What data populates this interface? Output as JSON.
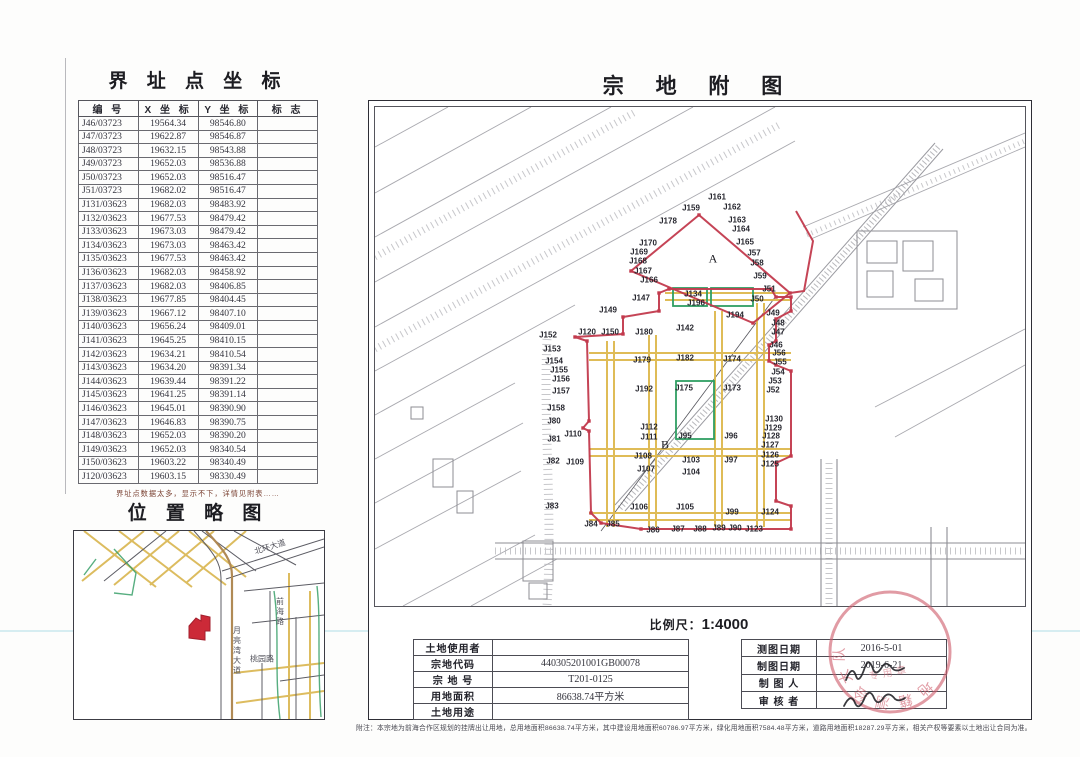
{
  "colors": {
    "boundary_red": "#c23a4d",
    "road_yellow": "#deb94f",
    "parcel_green": "#2f9e63",
    "topo_gray": "#a0a0a6",
    "seal_red": "#cf5f6e"
  },
  "coord": {
    "title": "界 址 点 坐 标",
    "headers": [
      "编    号",
      "X 坐 标",
      "Y 坐 标",
      "标    志"
    ],
    "rows": [
      [
        "J46/03723",
        "19564.34",
        "98546.80",
        ""
      ],
      [
        "J47/03723",
        "19622.87",
        "98546.87",
        ""
      ],
      [
        "J48/03723",
        "19632.15",
        "98543.88",
        ""
      ],
      [
        "J49/03723",
        "19652.03",
        "98536.88",
        ""
      ],
      [
        "J50/03723",
        "19652.03",
        "98516.47",
        ""
      ],
      [
        "J51/03723",
        "19682.02",
        "98516.47",
        ""
      ],
      [
        "J131/03623",
        "19682.03",
        "98483.92",
        ""
      ],
      [
        "J132/03623",
        "19677.53",
        "98479.42",
        ""
      ],
      [
        "J133/03623",
        "19673.03",
        "98479.42",
        ""
      ],
      [
        "J134/03623",
        "19673.03",
        "98463.42",
        ""
      ],
      [
        "J135/03623",
        "19677.53",
        "98463.42",
        ""
      ],
      [
        "J136/03623",
        "19682.03",
        "98458.92",
        ""
      ],
      [
        "J137/03623",
        "19682.03",
        "98406.85",
        ""
      ],
      [
        "J138/03623",
        "19677.85",
        "98404.45",
        ""
      ],
      [
        "J139/03623",
        "19667.12",
        "98407.10",
        ""
      ],
      [
        "J140/03623",
        "19656.24",
        "98409.01",
        ""
      ],
      [
        "J141/03623",
        "19645.25",
        "98410.15",
        ""
      ],
      [
        "J142/03623",
        "19634.21",
        "98410.54",
        ""
      ],
      [
        "J143/03623",
        "19634.20",
        "98391.34",
        ""
      ],
      [
        "J144/03623",
        "19639.44",
        "98391.22",
        ""
      ],
      [
        "J145/03623",
        "19641.25",
        "98391.14",
        ""
      ],
      [
        "J146/03623",
        "19645.01",
        "98390.90",
        ""
      ],
      [
        "J147/03623",
        "19646.83",
        "98390.75",
        ""
      ],
      [
        "J148/03623",
        "19652.03",
        "98390.20",
        ""
      ],
      [
        "J149/03623",
        "19652.03",
        "98340.54",
        ""
      ],
      [
        "J150/03623",
        "19603.22",
        "98340.49",
        ""
      ],
      [
        "J120/03623",
        "19603.15",
        "98330.49",
        ""
      ]
    ],
    "footnote": "界址点数据太多，显示不下，详情见附表……"
  },
  "location_map": {
    "title": "位 置 略 图",
    "labels": [
      {
        "t": "北环大道",
        "x": 196,
        "y": 16,
        "r": -17
      },
      {
        "t": "月亮湾大道",
        "x": 163,
        "y": 95,
        "v": true
      },
      {
        "t": "前海路",
        "x": 206,
        "y": 66,
        "v": true
      },
      {
        "t": "桃园路",
        "x": 188,
        "y": 128
      }
    ]
  },
  "parcel_map": {
    "title": "宗 地 附 图",
    "scale_label": "比例尺：",
    "scale_value": "1:4000",
    "boundaries": [
      {
        "close": true,
        "dots": true,
        "points": [
          [
            200,
            230
          ],
          [
            248,
            227
          ],
          [
            248,
            210
          ],
          [
            284,
            204
          ],
          [
            284,
            186
          ],
          [
            294,
            182
          ],
          [
            396,
            182
          ],
          [
            401,
            190
          ],
          [
            416,
            190
          ],
          [
            416,
            204
          ],
          [
            401,
            212
          ],
          [
            401,
            234
          ],
          [
            394,
            238
          ],
          [
            394,
            254
          ],
          [
            401,
            258
          ],
          [
            416,
            264
          ],
          [
            416,
            349
          ],
          [
            401,
            356
          ],
          [
            401,
            394
          ],
          [
            416,
            399
          ],
          [
            416,
            422
          ],
          [
            266,
            422
          ],
          [
            226,
            416
          ],
          [
            216,
            406
          ],
          [
            214,
            324
          ],
          [
            208,
            321
          ],
          [
            214,
            314
          ],
          [
            212,
            234
          ]
        ]
      },
      {
        "close": true,
        "dots": true,
        "points": [
          [
            324,
            108
          ],
          [
            415,
            186
          ],
          [
            378,
            216
          ],
          [
            256,
            164
          ]
        ]
      },
      {
        "close": false,
        "dots": false,
        "points": [
          [
            421,
            104
          ],
          [
            438,
            134
          ],
          [
            429,
            184
          ],
          [
            415,
            186
          ]
        ]
      }
    ],
    "labels": [
      {
        "t": "J159",
        "x": 316,
        "y": 101
      },
      {
        "t": "J161",
        "x": 342,
        "y": 90
      },
      {
        "t": "J162",
        "x": 357,
        "y": 100
      },
      {
        "t": "J163",
        "x": 362,
        "y": 113
      },
      {
        "t": "J164",
        "x": 366,
        "y": 122
      },
      {
        "t": "J165",
        "x": 370,
        "y": 135
      },
      {
        "t": "J57",
        "x": 379,
        "y": 146
      },
      {
        "t": "J58",
        "x": 382,
        "y": 156
      },
      {
        "t": "J59",
        "x": 385,
        "y": 169
      },
      {
        "t": "J51",
        "x": 394,
        "y": 182
      },
      {
        "t": "J50",
        "x": 382,
        "y": 192
      },
      {
        "t": "J178",
        "x": 293,
        "y": 114
      },
      {
        "t": "J170",
        "x": 273,
        "y": 136
      },
      {
        "t": "J169",
        "x": 264,
        "y": 145
      },
      {
        "t": "J168",
        "x": 263,
        "y": 154
      },
      {
        "t": "J167",
        "x": 268,
        "y": 164
      },
      {
        "t": "J166",
        "x": 274,
        "y": 173
      },
      {
        "t": "J147",
        "x": 266,
        "y": 191
      },
      {
        "t": "J149",
        "x": 233,
        "y": 203
      },
      {
        "t": "J134",
        "x": 318,
        "y": 187
      },
      {
        "t": "J196",
        "x": 321,
        "y": 196
      },
      {
        "t": "J194",
        "x": 360,
        "y": 208
      },
      {
        "t": "A",
        "x": 338,
        "y": 152,
        "c": "region"
      },
      {
        "t": "J152",
        "x": 173,
        "y": 228
      },
      {
        "t": "J120",
        "x": 212,
        "y": 225
      },
      {
        "t": "J150",
        "x": 235,
        "y": 225
      },
      {
        "t": "J180",
        "x": 269,
        "y": 225
      },
      {
        "t": "J142",
        "x": 310,
        "y": 221
      },
      {
        "t": "J153",
        "x": 177,
        "y": 242
      },
      {
        "t": "J154",
        "x": 179,
        "y": 254
      },
      {
        "t": "J155",
        "x": 184,
        "y": 263
      },
      {
        "t": "J156",
        "x": 186,
        "y": 272
      },
      {
        "t": "J157",
        "x": 186,
        "y": 284
      },
      {
        "t": "J158",
        "x": 181,
        "y": 301
      },
      {
        "t": "J179",
        "x": 267,
        "y": 253
      },
      {
        "t": "J182",
        "x": 310,
        "y": 251
      },
      {
        "t": "J174",
        "x": 357,
        "y": 252
      },
      {
        "t": "J192",
        "x": 269,
        "y": 282
      },
      {
        "t": "J175",
        "x": 309,
        "y": 281
      },
      {
        "t": "J173",
        "x": 357,
        "y": 281
      },
      {
        "t": "J80",
        "x": 179,
        "y": 314
      },
      {
        "t": "J110",
        "x": 198,
        "y": 327
      },
      {
        "t": "J112",
        "x": 274,
        "y": 320
      },
      {
        "t": "J111",
        "x": 274,
        "y": 330
      },
      {
        "t": "J95",
        "x": 310,
        "y": 329
      },
      {
        "t": "J96",
        "x": 356,
        "y": 329
      },
      {
        "t": "J81",
        "x": 179,
        "y": 332
      },
      {
        "t": "B",
        "x": 290,
        "y": 338,
        "c": "region"
      },
      {
        "t": "J82",
        "x": 178,
        "y": 354
      },
      {
        "t": "J109",
        "x": 200,
        "y": 355
      },
      {
        "t": "J108",
        "x": 268,
        "y": 349
      },
      {
        "t": "J107",
        "x": 271,
        "y": 362
      },
      {
        "t": "J103",
        "x": 316,
        "y": 353
      },
      {
        "t": "J104",
        "x": 316,
        "y": 365
      },
      {
        "t": "J97",
        "x": 356,
        "y": 353
      },
      {
        "t": "J83",
        "x": 177,
        "y": 399
      },
      {
        "t": "J106",
        "x": 264,
        "y": 400
      },
      {
        "t": "J105",
        "x": 310,
        "y": 400
      },
      {
        "t": "J99",
        "x": 357,
        "y": 405
      },
      {
        "t": "J124",
        "x": 395,
        "y": 405
      },
      {
        "t": "J84",
        "x": 216,
        "y": 417
      },
      {
        "t": "J85",
        "x": 238,
        "y": 417
      },
      {
        "t": "J86",
        "x": 278,
        "y": 423
      },
      {
        "t": "J87",
        "x": 303,
        "y": 422
      },
      {
        "t": "J88",
        "x": 325,
        "y": 422
      },
      {
        "t": "J89",
        "x": 344,
        "y": 421
      },
      {
        "t": "J90",
        "x": 360,
        "y": 421
      },
      {
        "t": "J123",
        "x": 379,
        "y": 422
      },
      {
        "t": "J49",
        "x": 398,
        "y": 206
      },
      {
        "t": "J48",
        "x": 403,
        "y": 216
      },
      {
        "t": "J47",
        "x": 403,
        "y": 225
      },
      {
        "t": "J46",
        "x": 401,
        "y": 238
      },
      {
        "t": "J56",
        "x": 404,
        "y": 246
      },
      {
        "t": "J55",
        "x": 405,
        "y": 255
      },
      {
        "t": "J54",
        "x": 403,
        "y": 265
      },
      {
        "t": "J53",
        "x": 400,
        "y": 274
      },
      {
        "t": "J52",
        "x": 398,
        "y": 283
      },
      {
        "t": "J130",
        "x": 399,
        "y": 312
      },
      {
        "t": "J129",
        "x": 398,
        "y": 321
      },
      {
        "t": "J128",
        "x": 396,
        "y": 329
      },
      {
        "t": "J127",
        "x": 395,
        "y": 338
      },
      {
        "t": "J126",
        "x": 395,
        "y": 348
      },
      {
        "t": "J125",
        "x": 395,
        "y": 357
      }
    ]
  },
  "info_table": {
    "rows": [
      {
        "label": "土地使用者",
        "value": ""
      },
      {
        "label": "宗地代码",
        "value": "440305201001GB00078"
      },
      {
        "label": "宗 地 号",
        "value": "T201-0125"
      },
      {
        "label": "用地面积",
        "value": "86638.74平方米"
      },
      {
        "label": "土地用途",
        "value": ""
      }
    ]
  },
  "meta_table": {
    "rows": [
      {
        "label": "测图日期",
        "value": "2016-5-01"
      },
      {
        "label": "制图日期",
        "value": "2019-6-21"
      },
      {
        "label": "制 图 人",
        "value": ""
      },
      {
        "label": "审 核 者",
        "value": ""
      }
    ]
  },
  "seal": {
    "ring_text": "地籍测绘大队",
    "inner_text": "专用章"
  },
  "footnote": "附注：本宗地为前海合作区规划的挂牌出让用地，总用地面积86638.74平方米，其中建设用地面积60786.97平方米，绿化用地面积7584.48平方米，道路用地面积18287.29平方米，相关产权等要素以土地出让合同为准。"
}
